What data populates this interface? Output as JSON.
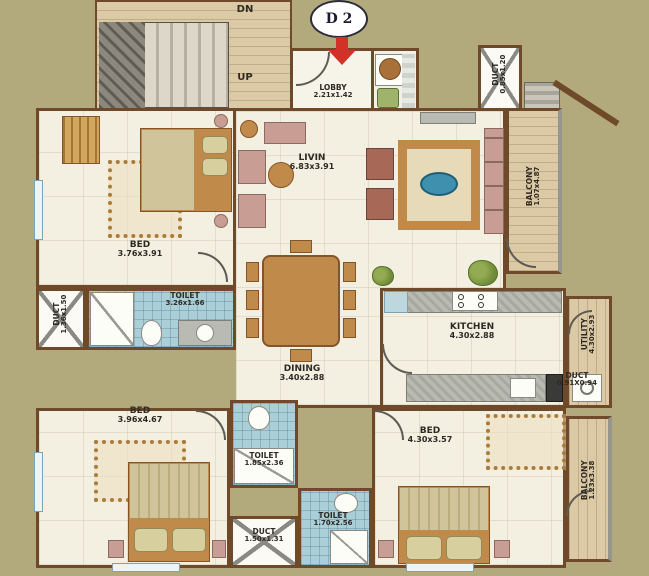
{
  "header": {
    "unit_badge": "D 2"
  },
  "stairs": {
    "down_label": "DN",
    "up_label": "UP"
  },
  "rooms": {
    "lobby": {
      "name": "LOBBY",
      "dims": "2.21x1.42"
    },
    "living": {
      "name": "LIVIN",
      "dims": "6.83x3.91"
    },
    "bed1": {
      "name": "BED",
      "dims": "3.76x3.91"
    },
    "toilet1": {
      "name": "TOILET",
      "dims": "3.26x1.66"
    },
    "duct1": {
      "name": "DUCT",
      "dims": "1.36x1.50"
    },
    "kitchen": {
      "name": "KITCHEN",
      "dims": "4.30x2.88"
    },
    "utility": {
      "name": "UTILITY",
      "dims": "4.30x2.93"
    },
    "duct2": {
      "name": "DUCT",
      "dims": "0.91X0.94"
    },
    "dining": {
      "name": "DINING",
      "dims": "3.40x2.88"
    },
    "bed2": {
      "name": "BED",
      "dims": "3.96x4.67"
    },
    "toilet2": {
      "name": "TOILET",
      "dims": "1.85x2.36"
    },
    "toilet3": {
      "name": "TOILET",
      "dims": "1.70x2.56"
    },
    "duct3": {
      "name": "DUCT",
      "dims": "1.50x1.31"
    },
    "bed3": {
      "name": "BED",
      "dims": "4.30x3.57"
    },
    "balcony1": {
      "name": "BALCONY",
      "dims": "1.07x4.87"
    },
    "balcony2": {
      "name": "BALCONY",
      "dims": "1.23x3.38"
    },
    "duct4": {
      "name": "DUCT",
      "dims": "0.85x1.20"
    }
  },
  "colors": {
    "background": "#b2aa7c",
    "wall": "#6f4a2a",
    "floor": "#f3efe1",
    "tile_blue": "#aacfd8",
    "tan_floor": "#dcc9a5",
    "entry_arrow_red": "#d23127",
    "wood": "#c08a4a",
    "sofa_pink": "#c89e94",
    "counter_gray": "#b9bab2",
    "plant_green": "#7f9a45"
  }
}
